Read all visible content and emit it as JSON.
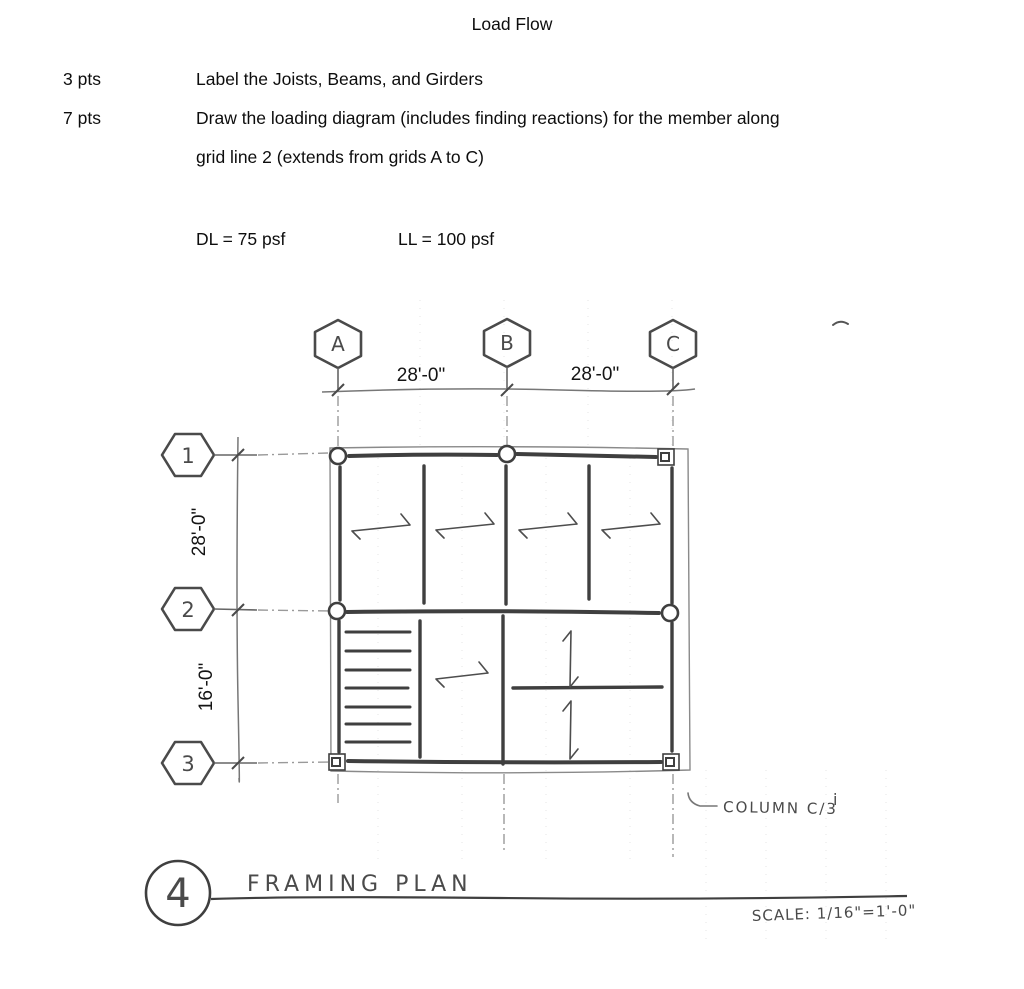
{
  "page": {
    "title": "Load Flow",
    "task1_points": "3 pts",
    "task1_text": "Label the Joists, Beams, and Girders",
    "task2_points": "7 pts",
    "task2_line1": "Draw the loading diagram (includes finding reactions) for the member along",
    "task2_line2": "grid line 2 (extends from grids A to C)",
    "dead_load": "DL = 75 psf",
    "live_load": "LL = 100 psf"
  },
  "plan": {
    "grid_cols": [
      "A",
      "B",
      "C"
    ],
    "grid_rows": [
      "1",
      "2",
      "3"
    ],
    "dims": {
      "ab": "28'-0\"",
      "bc": "28'-0\"",
      "r12": "28'-0\"",
      "r23": "16'-0\""
    },
    "column_note": "COLUMN C/3",
    "stray_mark": "i",
    "detail": {
      "number": "4",
      "title": "FRAMING PLAN",
      "scale": "SCALE: 1/16\"=1'-0\""
    }
  },
  "colors": {
    "ink": "#3f3f3f",
    "pencil": "#777777",
    "typed": "#0d0d0d"
  }
}
